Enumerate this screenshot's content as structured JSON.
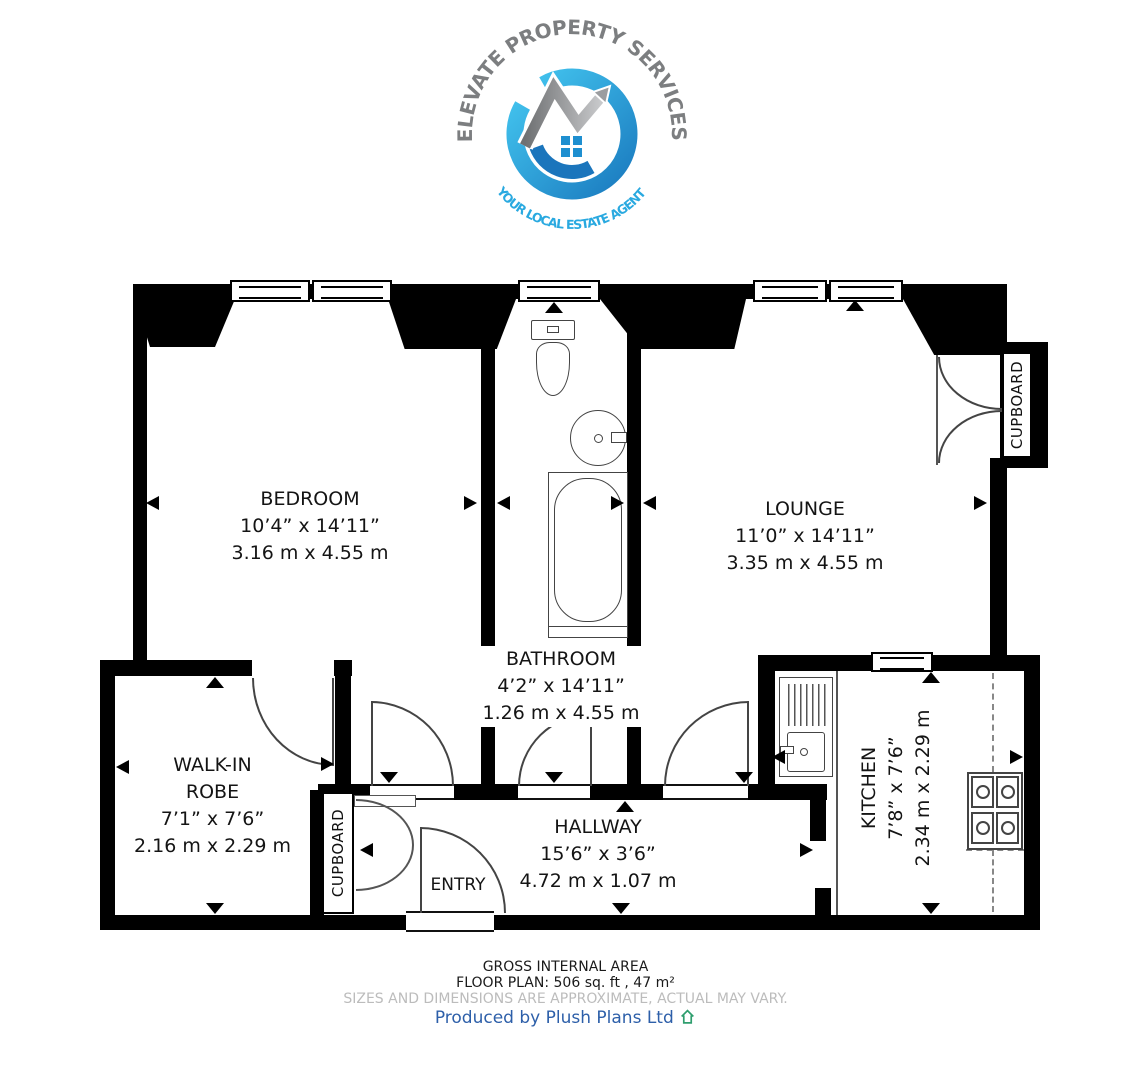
{
  "logo": {
    "arc_top": "ELEVATE PROPERTY SERVICES",
    "arc_bottom": "YOUR LOCAL ESTATE AGENT"
  },
  "rooms": {
    "bedroom": {
      "name": "BEDROOM",
      "imperial": "10’4” x 14’11”",
      "metric": "3.16 m x 4.55 m"
    },
    "bathroom": {
      "name": "BATHROOM",
      "imperial": "4’2” x 14’11”",
      "metric": "1.26 m x 4.55 m"
    },
    "lounge": {
      "name": "LOUNGE",
      "imperial": "11’0” x 14’11”",
      "metric": "3.35 m x 4.55 m"
    },
    "walk_in_robe": {
      "line1": "WALK-IN",
      "line2": "ROBE",
      "imperial": "7’1” x 7’6”",
      "metric": "2.16 m x 2.29 m"
    },
    "hallway": {
      "name": "HALLWAY",
      "imperial": "15’6” x 3’6”",
      "metric": "4.72 m x 1.07 m"
    },
    "kitchen": {
      "name": "KITCHEN",
      "imperial": "7’8” x 7’6”",
      "metric": "2.34 m x 2.29 m"
    }
  },
  "labels": {
    "cupboard_lounge": "CUPBOARD",
    "cupboard_hallway": "CUPBOARD",
    "entry": "ENTRY"
  },
  "footer": {
    "area_title": "GROSS INTERNAL AREA",
    "area_detail": "FLOOR PLAN: 506 sq. ft , 47 m²",
    "disclaimer": "SIZES AND DIMENSIONS ARE APPROXIMATE, ACTUAL MAY VARY.",
    "credit": "Produced by Plush Plans Ltd"
  },
  "colors": {
    "logo_blue": "#29abe2",
    "logo_dark_blue": "#1b75bc",
    "logo_gray": "#7c7e80",
    "credit_blue": "#2d5fa9",
    "disclaimer_gray": "#bcbcbc",
    "wall_black": "#000000"
  }
}
